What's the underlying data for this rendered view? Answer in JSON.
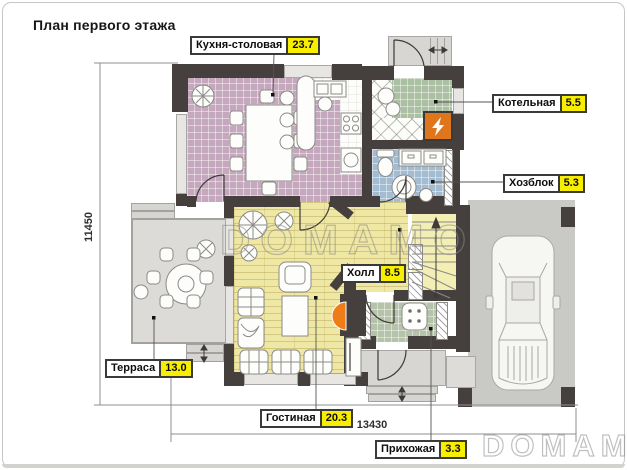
{
  "title": "План первого этажа",
  "rooms": [
    {
      "name": "Кухня-столовая",
      "area": "23.7"
    },
    {
      "name": "Котельная",
      "area": "5.5"
    },
    {
      "name": "Хозблок",
      "area": "5.3"
    },
    {
      "name": "Холл",
      "area": "8.5"
    },
    {
      "name": "Терраса",
      "area": "13.0"
    },
    {
      "name": "Гостиная",
      "area": "20.3"
    },
    {
      "name": "Прихожая",
      "area": "3.3"
    }
  ],
  "dimensions": {
    "vertical": "11450",
    "horizontal": "13430"
  },
  "watermark": {
    "center": "DOMAMO",
    "corner": "DOMAMO"
  },
  "colors": {
    "wall": "#45403d",
    "kitchen_floor": "#c5a8bd",
    "boiler_floor": "#abc0a2",
    "utility_floor": "#a3bcd2",
    "wood_floor": "#efe8a5",
    "entry_floor": "#b4c3a9",
    "terrace_floor": "#dcdbd7",
    "driveway": "#c9c9c5",
    "area_badge": "#f8ee00",
    "boiler_unit": "#e0761c",
    "fireplace": "#ef7d17"
  }
}
